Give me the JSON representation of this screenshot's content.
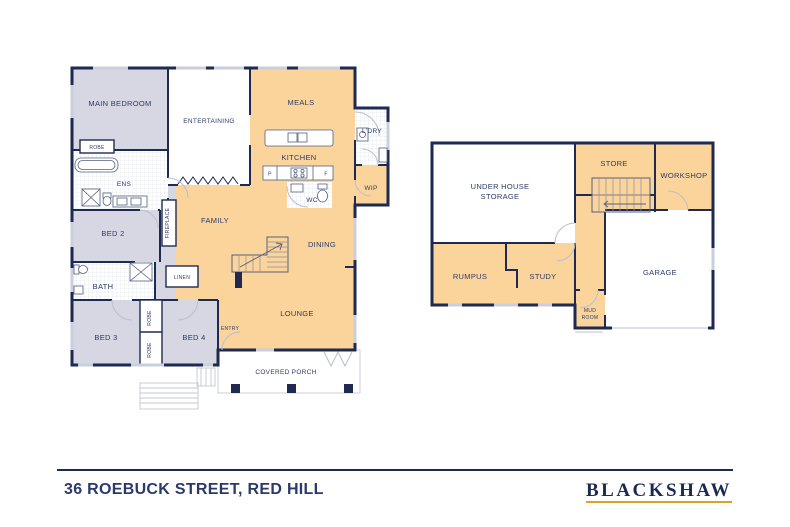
{
  "footer": {
    "address": "36 ROEBUCK STREET, RED HILL",
    "brand": "BLACKSHAW"
  },
  "colors": {
    "wall_navy": "#1e2a52",
    "room_orange": "#fbd49c",
    "room_lavender": "#d7d7e3",
    "label_navy": "#2d3a66",
    "brand_gold": "#d9a520",
    "window_grey": "#c9cfdd"
  },
  "upper": {
    "rooms": {
      "main_bedroom": "MAIN BEDROOM",
      "robe": "ROBE",
      "ens": "ENS",
      "entertaining": "ENTERTAINING",
      "meals": "MEALS",
      "kitchen": "KITCHEN",
      "pantry_abbr": "P",
      "fridge_abbr": "F",
      "wc": "WC",
      "laundry": "L'DRY",
      "wip": "WIP",
      "fireplace": "FIREPLACE",
      "family": "FAMILY",
      "dining": "DINING",
      "lounge": "LOUNGE",
      "bed2": "BED 2",
      "bath": "BATH",
      "linen": "LINEN",
      "bed3": "BED 3",
      "bed4": "BED 4",
      "entry": "ENTRY",
      "covered_porch": "COVERED PORCH"
    }
  },
  "lower": {
    "rooms": {
      "under_house_storage_line1": "UNDER HOUSE",
      "under_house_storage_line2": "STORAGE",
      "store": "STORE",
      "workshop": "WORKSHOP",
      "rumpus": "RUMPUS",
      "study": "STUDY",
      "garage": "GARAGE",
      "mud_room_line1": "MUD",
      "mud_room_line2": "ROOM"
    }
  }
}
